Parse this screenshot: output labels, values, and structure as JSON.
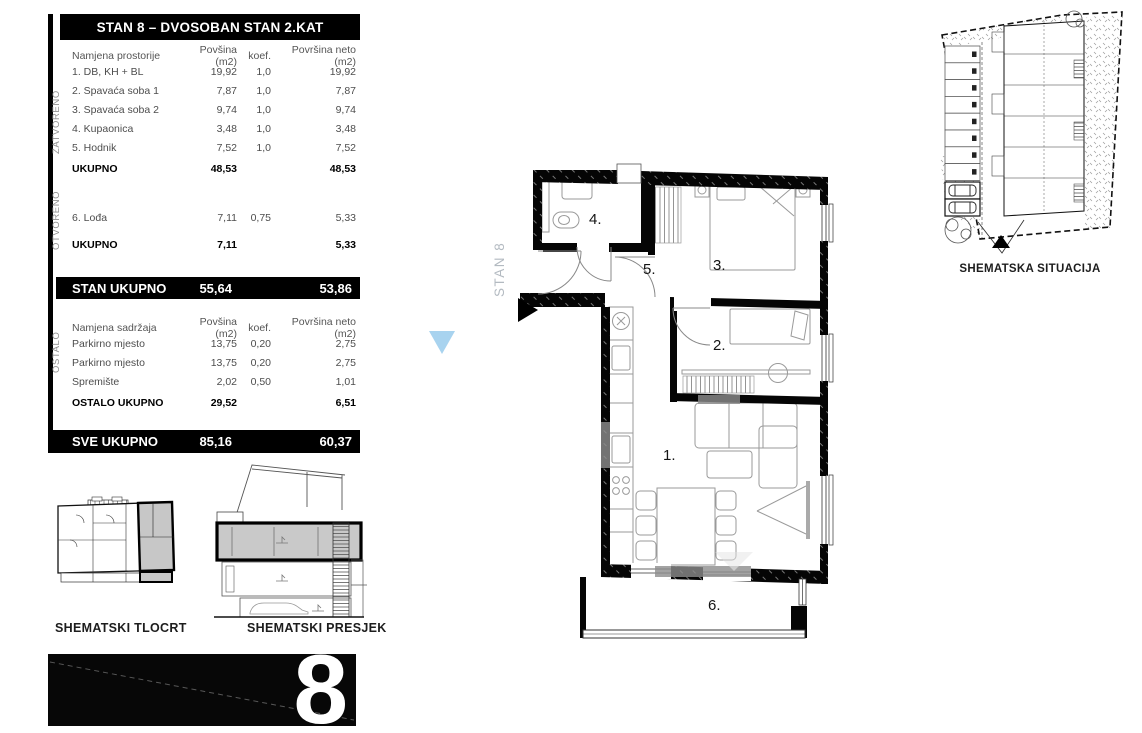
{
  "table": {
    "title": "STAN 8 – DVOSOBAN STAN 2.KAT",
    "columns": {
      "name": "Namjena prostorije",
      "area": "Povšina (m2)",
      "koef": "koef.",
      "neto": "Površina neto (m2)"
    },
    "columns2": {
      "name": "Namjena sadržaja",
      "area": "Povšina (m2)",
      "koef": "koef.",
      "neto": "Površina neto (m2)"
    },
    "zatvoreno": {
      "side_label": "ZATVORENO",
      "rows": [
        {
          "name": "1. DB, KH + BL",
          "area": "19,92",
          "koef": "1,0",
          "neto": "19,92"
        },
        {
          "name": "2. Spavaća soba 1",
          "area": "7,87",
          "koef": "1,0",
          "neto": "7,87"
        },
        {
          "name": "3. Spavaća soba 2",
          "area": "9,74",
          "koef": "1,0",
          "neto": "9,74"
        },
        {
          "name": "4. Kupaonica",
          "area": "3,48",
          "koef": "1,0",
          "neto": "3,48"
        },
        {
          "name": "5. Hodnik",
          "area": "7,52",
          "koef": "1,0",
          "neto": "7,52"
        }
      ],
      "total": {
        "label": "UKUPNO",
        "area": "48,53",
        "neto": "48,53"
      }
    },
    "otvoreno": {
      "side_label": "OTVORENO",
      "rows": [
        {
          "name": "6. Lođa",
          "area": "7,11",
          "koef": "0,75",
          "neto": "5,33"
        }
      ],
      "total": {
        "label": "UKUPNO",
        "area": "7,11",
        "neto": "5,33"
      }
    },
    "stan_total": {
      "label": "STAN UKUPNO",
      "area": "55,64",
      "neto": "53,86"
    },
    "ostalo": {
      "side_label": "OSTALO",
      "rows": [
        {
          "name": "Parkirno mjesto",
          "area": "13,75",
          "koef": "0,20",
          "neto": "2,75"
        },
        {
          "name": "Parkirno mjesto",
          "area": "13,75",
          "koef": "0,20",
          "neto": "2,75"
        },
        {
          "name": "Spremište",
          "area": "2,02",
          "koef": "0,50",
          "neto": "1,01"
        }
      ],
      "total": {
        "label": "OSTALO UKUPNO",
        "area": "29,52",
        "neto": "6,51"
      }
    },
    "sve_total": {
      "label": "SVE UKUPNO",
      "area": "85,16",
      "neto": "60,37"
    }
  },
  "plan": {
    "unit_label": "STAN 8",
    "rooms": [
      {
        "label": "1."
      },
      {
        "label": "2."
      },
      {
        "label": "3."
      },
      {
        "label": "4."
      },
      {
        "label": "5."
      },
      {
        "label": "6."
      }
    ]
  },
  "captions": {
    "situacija": "SHEMATSKA SITUACIJA",
    "tlocrt": "SHEMATSKI TLOCRT",
    "presjek": "SHEMATSKI PRESJEK"
  },
  "banner": {
    "number": "8"
  },
  "colors": {
    "accent_blue": "#a8d3ef",
    "highlight_gray": "#c8c8c8",
    "wall_black": "#050505"
  }
}
